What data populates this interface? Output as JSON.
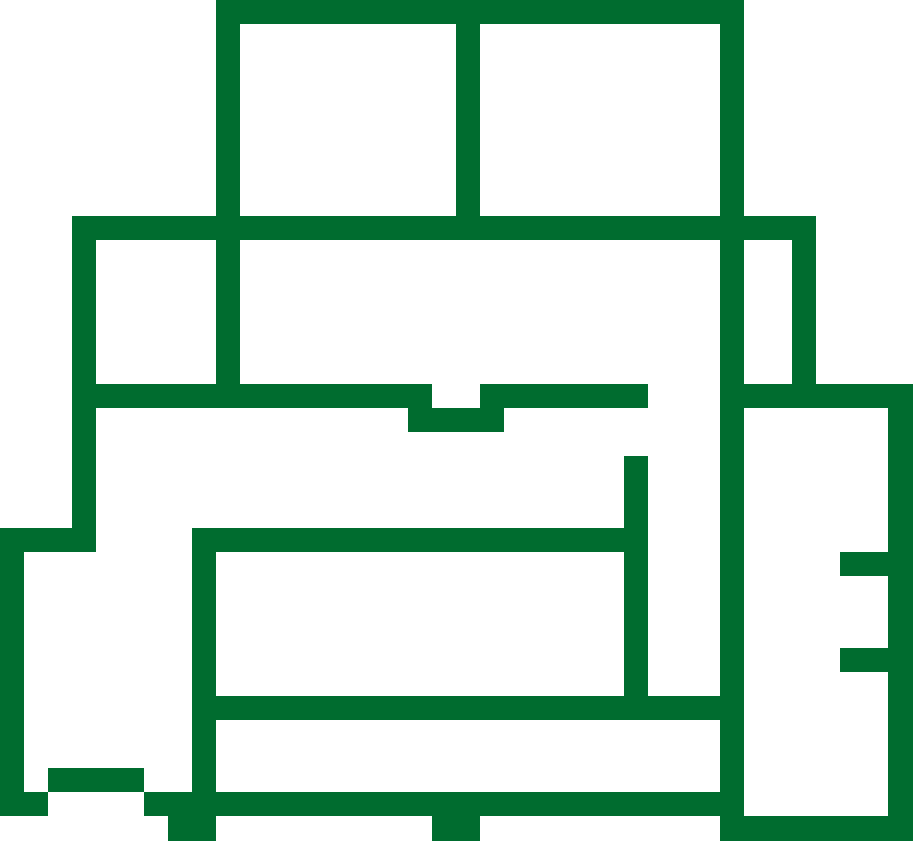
{
  "figure": {
    "title": "green-floor-plan-outline",
    "type": "line-drawing",
    "background_color": "#ffffff",
    "stroke_color": "#006C2F",
    "stroke_thickness": 24,
    "canvas": {
      "width": 913,
      "height": 841
    },
    "rects": [
      {
        "name": "top-wall",
        "x": 216,
        "y": 0,
        "w": 528,
        "h": 24
      },
      {
        "name": "upper-left-vertical-wall",
        "x": 216,
        "y": 0,
        "w": 24,
        "h": 408
      },
      {
        "name": "top-room-divider-wall",
        "x": 456,
        "y": 0,
        "w": 24,
        "h": 240
      },
      {
        "name": "upper-horizontal-wall",
        "x": 72,
        "y": 216,
        "w": 744,
        "h": 24
      },
      {
        "name": "left-upper-vertical-wall",
        "x": 72,
        "y": 216,
        "w": 24,
        "h": 336
      },
      {
        "name": "right-upper-short-vertical-wall",
        "x": 792,
        "y": 240,
        "w": 24,
        "h": 144
      },
      {
        "name": "middle-wall-left-segment",
        "x": 96,
        "y": 384,
        "w": 336,
        "h": 24
      },
      {
        "name": "middle-wall-jog",
        "x": 408,
        "y": 408,
        "w": 96,
        "h": 24
      },
      {
        "name": "middle-wall-right-segment",
        "x": 480,
        "y": 384,
        "w": 168,
        "h": 24
      },
      {
        "name": "middle-wall-far-right-segment",
        "x": 720,
        "y": 384,
        "w": 193,
        "h": 24
      },
      {
        "name": "main-right-vertical-wall",
        "x": 720,
        "y": 0,
        "w": 24,
        "h": 841
      },
      {
        "name": "right-edge-vertical-wall",
        "x": 888,
        "y": 408,
        "w": 25,
        "h": 433
      },
      {
        "name": "right-edge-upper-tab",
        "x": 840,
        "y": 552,
        "w": 48,
        "h": 24
      },
      {
        "name": "right-edge-lower-tab",
        "x": 840,
        "y": 648,
        "w": 48,
        "h": 24
      },
      {
        "name": "center-right-vertical-wall",
        "x": 624,
        "y": 456,
        "w": 24,
        "h": 264
      },
      {
        "name": "inner-room-top-wall",
        "x": 192,
        "y": 528,
        "w": 456,
        "h": 24
      },
      {
        "name": "left-step-horizontal-wall",
        "x": 0,
        "y": 528,
        "w": 96,
        "h": 24
      },
      {
        "name": "left-edge-vertical-wall",
        "x": 0,
        "y": 552,
        "w": 24,
        "h": 264
      },
      {
        "name": "bottom-left-stub",
        "x": 0,
        "y": 792,
        "w": 48,
        "h": 24
      },
      {
        "name": "bottom-left-step",
        "x": 48,
        "y": 768,
        "w": 96,
        "h": 24
      },
      {
        "name": "inner-room-left-wall",
        "x": 192,
        "y": 528,
        "w": 24,
        "h": 288
      },
      {
        "name": "inner-room-bottom-wall",
        "x": 192,
        "y": 696,
        "w": 552,
        "h": 24
      },
      {
        "name": "lower-horizontal-wall",
        "x": 144,
        "y": 792,
        "w": 600,
        "h": 24
      },
      {
        "name": "bottom-left-leg",
        "x": 168,
        "y": 816,
        "w": 48,
        "h": 25
      },
      {
        "name": "bottom-middle-leg",
        "x": 432,
        "y": 816,
        "w": 48,
        "h": 25
      },
      {
        "name": "bottom-right-block",
        "x": 720,
        "y": 816,
        "w": 193,
        "h": 25
      }
    ]
  }
}
